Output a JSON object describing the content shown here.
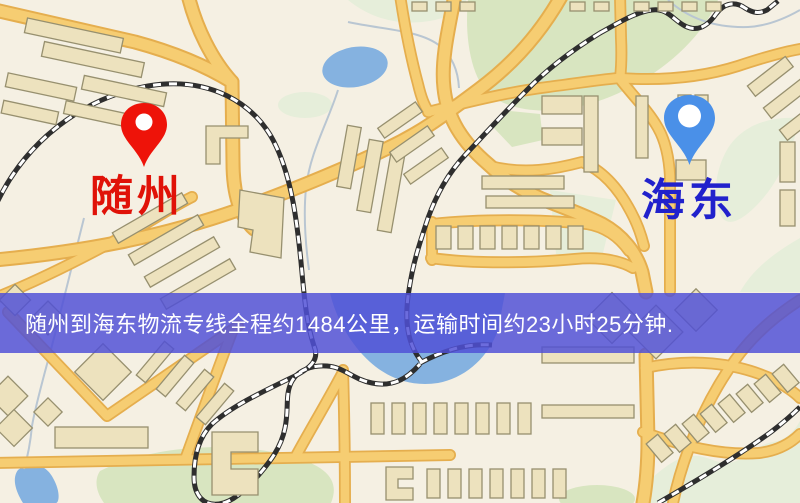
{
  "banner": {
    "text": "随州到海东物流专线全程约1484公里，运输时间约23小时25分钟.",
    "background_rgba": "rgba(80,80,214,0.84)",
    "text_color": "#ffffff"
  },
  "markers": {
    "origin": {
      "label": "随州",
      "pin_color": "#ee1309",
      "label_color": "#e01208"
    },
    "destination": {
      "label": "海东",
      "pin_color": "#4a90e8",
      "label_color": "#2121cc"
    }
  },
  "map_palette": {
    "background": "#f5f0e3",
    "road": "#f6cd72",
    "road_casing": "#e5ae4e",
    "building": "#ede2be",
    "building_outline": "#97906f",
    "park": "#d8e5c0",
    "park_pale": "#e6eeda",
    "water": "#85b2e0",
    "railway": "#2e2e2e",
    "stream": "#b9c6d2"
  }
}
